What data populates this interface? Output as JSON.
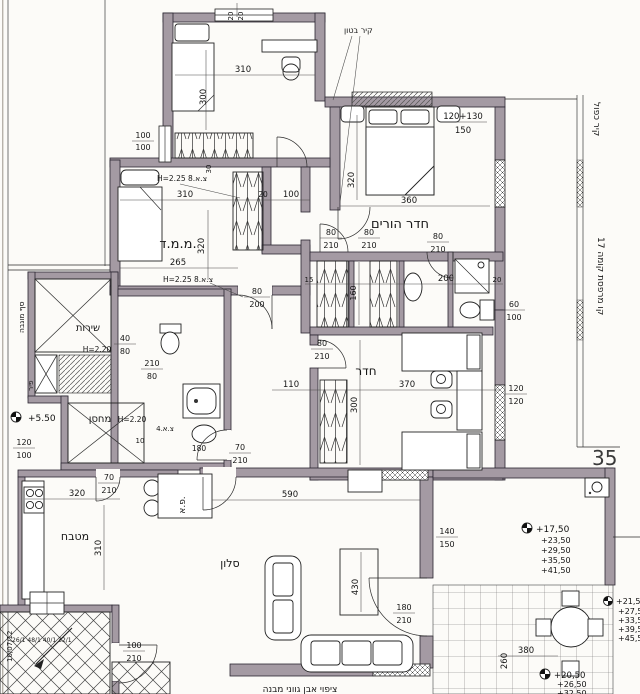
{
  "colors": {
    "wall": "#a49aa3",
    "line": "#1c1c1c",
    "paper": "#fcfbf8"
  },
  "sheet": {
    "number": "35",
    "revision_note": "10/07/12",
    "bottom_note": "ציפוי אבן גווני מבנה"
  },
  "rooms": {
    "master_bedroom": "חדר הורים",
    "safe_room": "מ.מ.ד.",
    "bedroom": "חדר",
    "kitchen": "מטבח",
    "living_room": "סלון",
    "service_balcony": "שירות",
    "storage": "מחסן",
    "dining_nook": "פ.א."
  },
  "annotations": {
    "concrete_wall": "קיר בטון",
    "double_wall": "קיר כפול",
    "balcony_line_floor_17": "קו מרפסת קומה 17",
    "raised_sill": "סף מוגבה",
    "shaft": "פיר",
    "ceiling_vent": "H=2.25 צ.א.8",
    "h220": "H=2.20",
    "vent_4": "צ.א.4",
    "stair_note": "26/1 48/1 40/1 32/1"
  },
  "levels": {
    "entry": "+5.50",
    "balcony": [
      "+17,50",
      "+23,50",
      "+29,50",
      "+35,50",
      "+41,50"
    ],
    "right_edge": [
      "+21,50",
      "+27,50",
      "+33,50",
      "+39,50",
      "+45,50"
    ],
    "bottom_edge": [
      "+20,50",
      "+26,50",
      "+32,50"
    ]
  },
  "dims": {
    "d20_20": {
      "top": "20",
      "bot": "20"
    },
    "d310": "310",
    "d300": "300",
    "d100_100": {
      "top": "100",
      "bot": "100"
    },
    "d30": "30",
    "d310b": "310",
    "d320": "320",
    "d265": "265",
    "d80_200": {
      "top": "80",
      "bot": "200"
    },
    "d20": "20",
    "d100": "100",
    "d360": "360",
    "d320m": "320",
    "d120p130": "120+130",
    "d150": "150",
    "d60_100": {
      "top": "60",
      "bot": "100"
    },
    "d120_120": {
      "top": "120",
      "bot": "120"
    },
    "d80_210": {
      "top": "80",
      "bot": "210"
    },
    "d15": "15",
    "d160": "160",
    "d200": "200",
    "d20c": "20",
    "d110": "110",
    "d370": "370",
    "d300r": "300",
    "d210_80": {
      "top": "210",
      "bot": "80"
    },
    "d40_80": {
      "top": "40",
      "bot": "80"
    },
    "d120_100": {
      "top": "120",
      "bot": "100"
    },
    "d180": "180",
    "d10": "10",
    "d70_210": {
      "top": "70",
      "bot": "210"
    },
    "d100_210": {
      "top": "100",
      "bot": "210"
    },
    "d320k": "320",
    "d310k": "310",
    "d590": "590",
    "d430": "430",
    "d180_210": {
      "top": "180",
      "bot": "210"
    },
    "d140_150": {
      "top": "140",
      "bot": "150"
    },
    "d380": "380",
    "d260": "260"
  }
}
